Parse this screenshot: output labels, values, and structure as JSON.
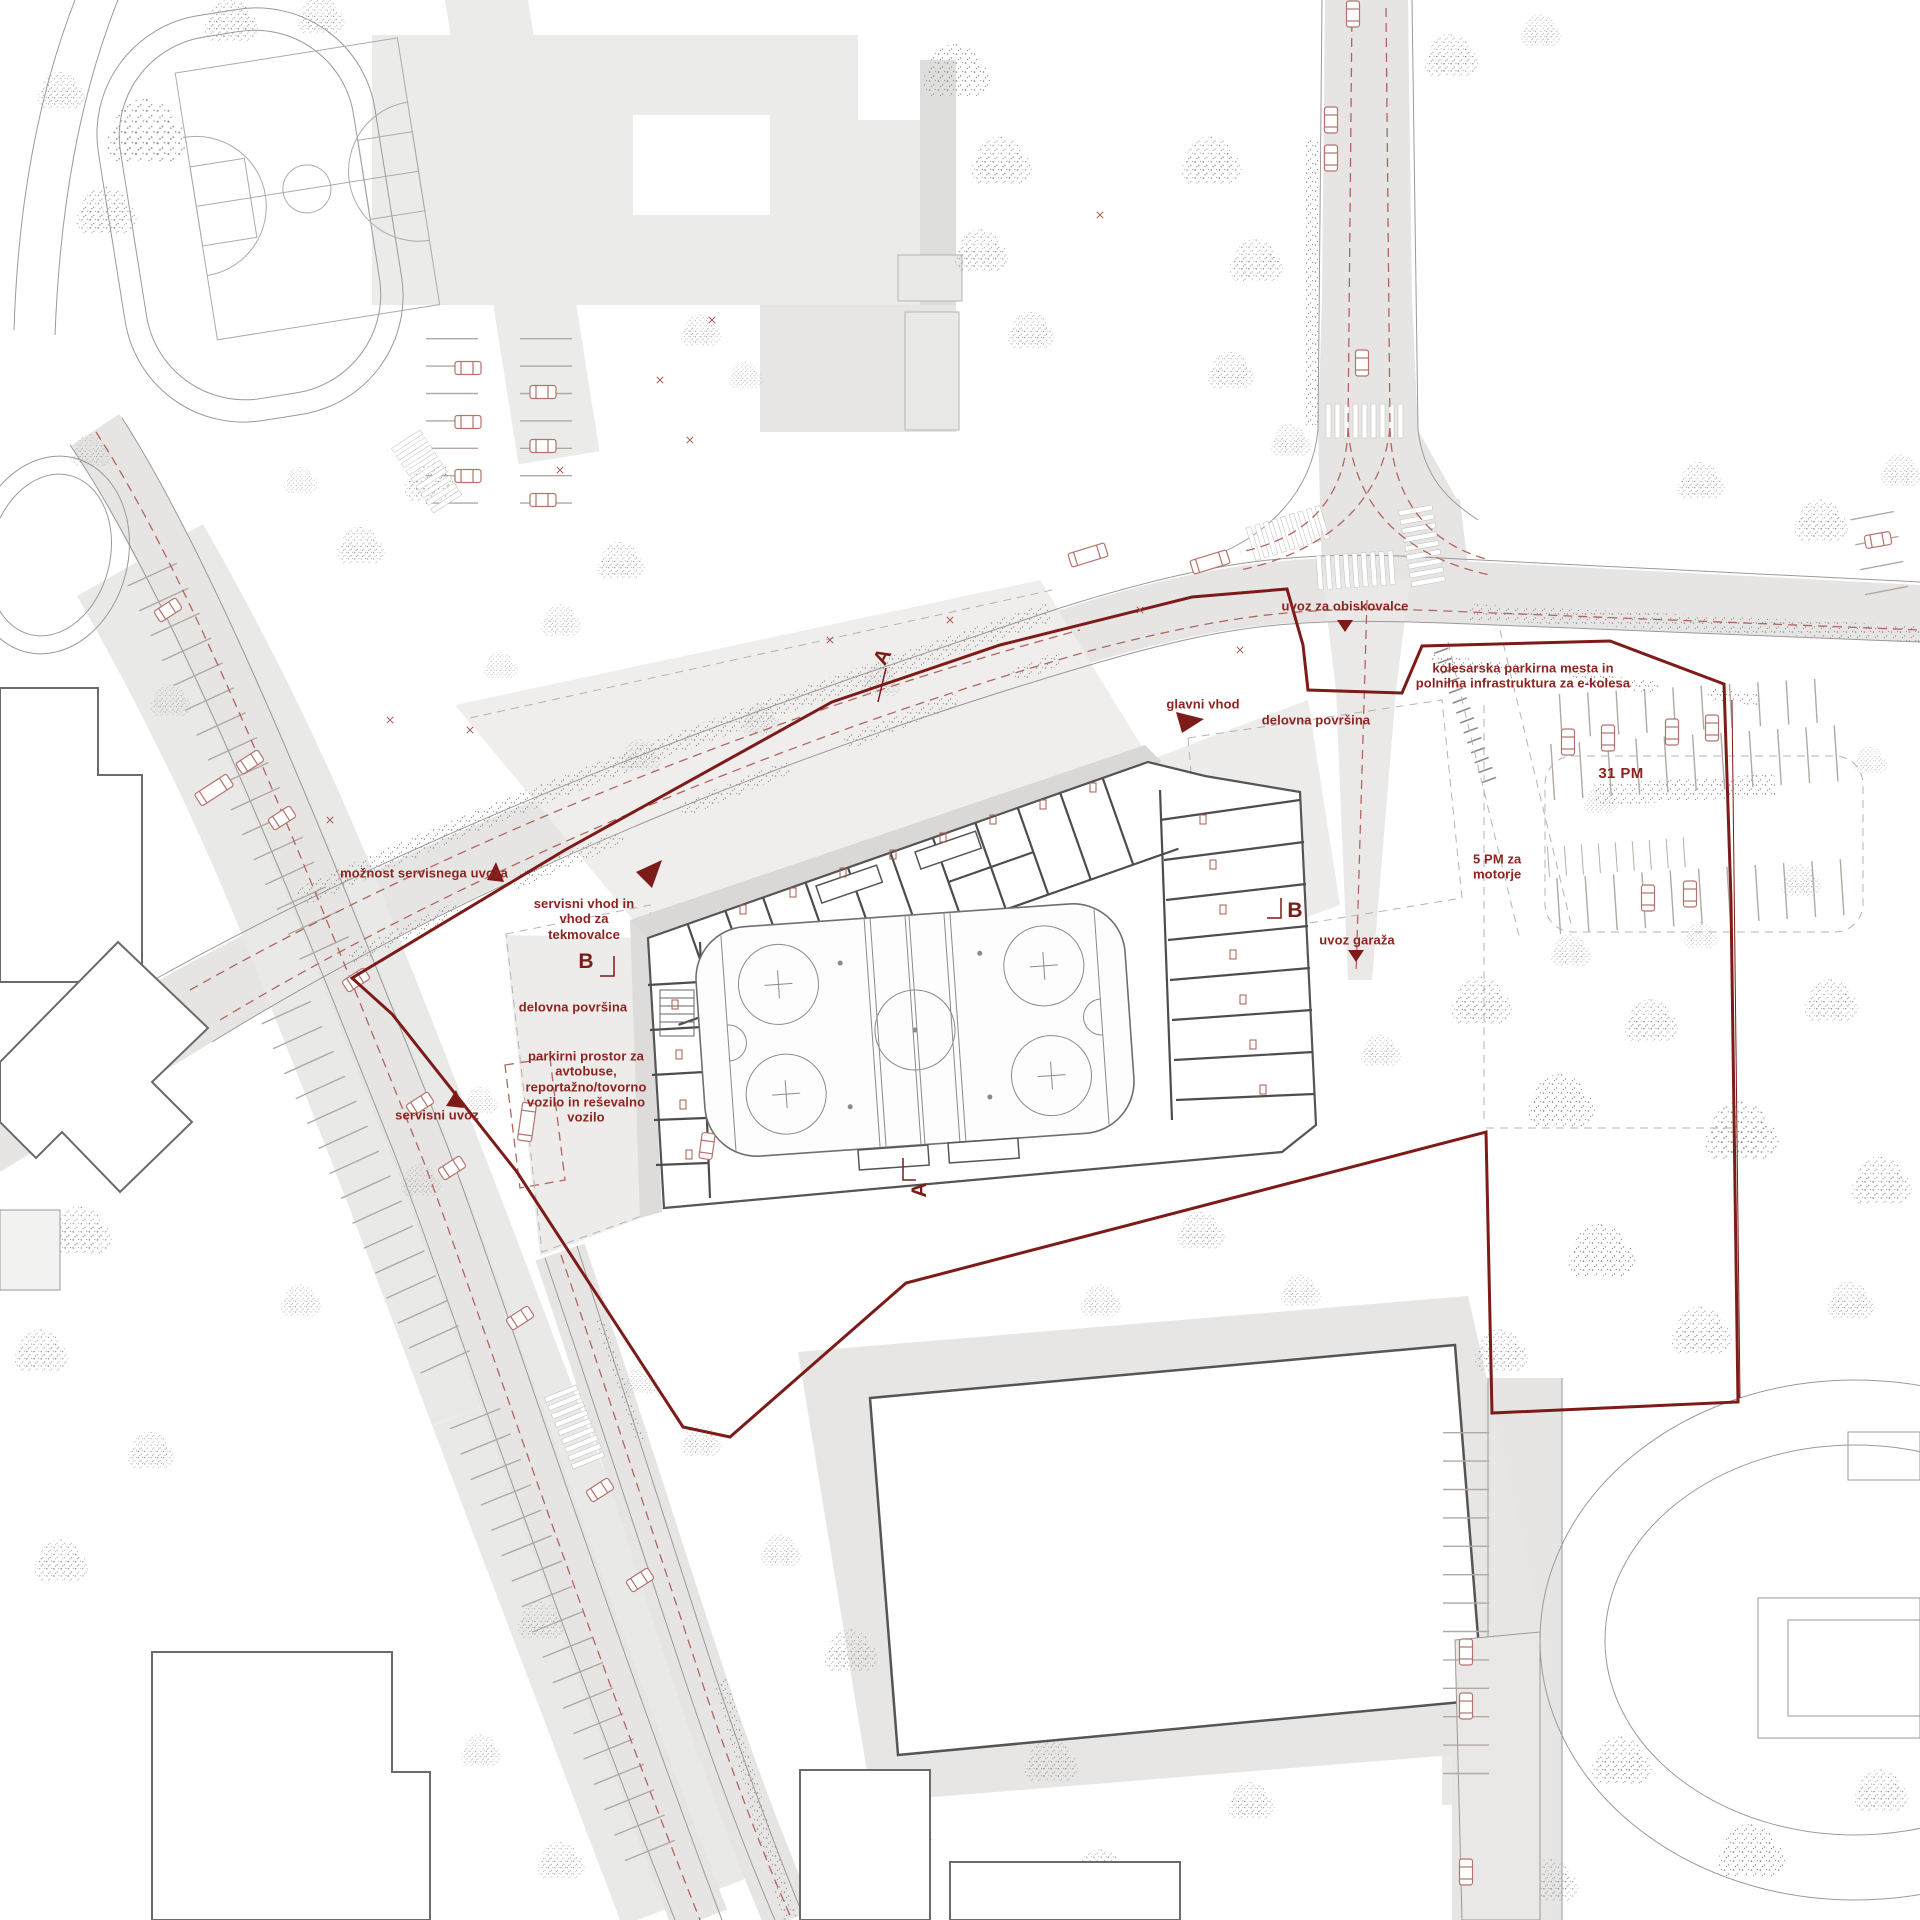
{
  "annotations": {
    "uvoz_za_obiskovalce": "uvoz za obiskovalce",
    "kolesarska": "kolesarska parkirna mesta in\npolnilna infrastruktura za e-kolesa",
    "glavni_vhod": "glavni vhod",
    "delovna_povrsina_right": "delovna površina",
    "pm31": "31 PM",
    "pm5": "5 PM za\nmotorje",
    "uvoz_garaza": "uvoz garaža",
    "moznost_servisnega_uvoza": "možnost servisnega uvoza",
    "servisni_vhod": "servisni vhod in\nvhod za\ntekmovalce",
    "delovna_povrsina_left": "delovna površina",
    "parkirni_prostor": "parkirni prostor za\navtobuse,\nreportažno/tovorno\nvozilo in reševalno\nvozilo",
    "servisni_uvoz": "servisni uvoz"
  },
  "section_markers": {
    "a_top": "A",
    "a_bottom": "A",
    "b_left": "B",
    "b_right": "B"
  },
  "colors": {
    "accent_text": "#8e2421",
    "site_boundary": "#7c1b18",
    "red_dashed": "#b2655e",
    "car_outline": "#b4736c",
    "road_fill": "#e6e5e4",
    "building_fill": "#ebebea",
    "wall": "#4d4d4d",
    "tree_dot": "#8c8c8c"
  }
}
